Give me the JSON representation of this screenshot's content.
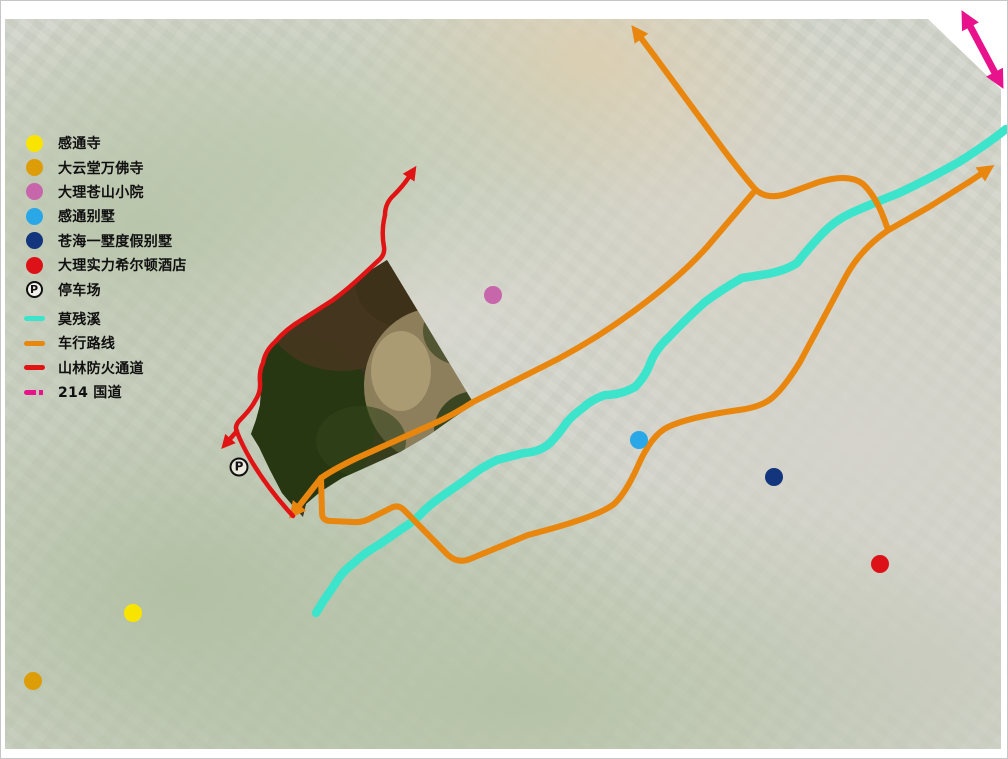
{
  "colors": {
    "marker-yellow": "#f9e400",
    "marker-orange": "#dc9d06",
    "marker-pink": "#c766ab",
    "marker-lightblue": "#2aa7e6",
    "marker-navy": "#13357d",
    "marker-red": "#dd1218",
    "route-cyan": "#3ce4cb",
    "route-orange": "#e8860d",
    "route-red": "#e01414",
    "route-magenta": "#e8138c"
  },
  "parking_symbol": "P",
  "legend": {
    "items": [
      {
        "id": "gantong-temple",
        "swatch": "dot",
        "color": "marker-yellow",
        "label": "感通寺"
      },
      {
        "id": "dayuntang-wanfo-temple",
        "swatch": "dot",
        "color": "marker-orange",
        "label": "大云堂万佛寺"
      },
      {
        "id": "dali-cangshan-courtyard",
        "swatch": "dot",
        "color": "marker-pink",
        "label": "大理苍山小院"
      },
      {
        "id": "gantong-villa",
        "swatch": "dot",
        "color": "marker-lightblue",
        "label": "感通别墅"
      },
      {
        "id": "canghai-villa-resort",
        "swatch": "dot",
        "color": "marker-navy",
        "label": "苍海一墅度假别墅"
      },
      {
        "id": "dali-hilton-hotel",
        "swatch": "dot",
        "color": "marker-red",
        "label": "大理实力希尔顿酒店"
      },
      {
        "id": "parking",
        "swatch": "parking",
        "label": "停车场"
      },
      {
        "id": "mocan-stream",
        "swatch": "line",
        "color": "route-cyan",
        "label": "莫残溪"
      },
      {
        "id": "driving-route",
        "swatch": "line",
        "color": "route-orange",
        "label": "车行路线"
      },
      {
        "id": "fire-channel",
        "swatch": "line",
        "color": "route-red",
        "label": "山林防火通道"
      },
      {
        "id": "g214-highway",
        "swatch": "line-dashed",
        "color": "route-magenta",
        "label": "214 国道"
      }
    ]
  },
  "map": {
    "markers": [
      {
        "name": "dali-cangshan-courtyard-marker",
        "type": "dot",
        "color": "marker-pink",
        "x": 492,
        "y": 294
      },
      {
        "name": "gantong-villa-marker",
        "type": "dot",
        "color": "marker-lightblue",
        "x": 638,
        "y": 439
      },
      {
        "name": "canghai-villa-resort-marker",
        "type": "dot",
        "color": "marker-navy",
        "x": 773,
        "y": 476
      },
      {
        "name": "dali-hilton-hotel-marker",
        "type": "dot",
        "color": "marker-red",
        "x": 879,
        "y": 563
      },
      {
        "name": "gantong-temple-marker",
        "type": "dot",
        "color": "marker-yellow",
        "x": 132,
        "y": 612
      },
      {
        "name": "dayuntang-wanfo-temple-marker",
        "type": "dot",
        "color": "marker-orange",
        "x": 32,
        "y": 680
      },
      {
        "name": "parking-marker",
        "type": "parking",
        "x": 238,
        "y": 466
      }
    ]
  }
}
